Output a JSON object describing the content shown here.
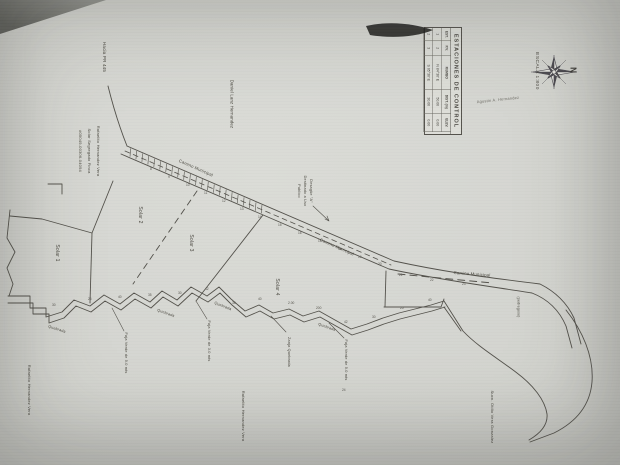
{
  "title_block": {
    "table": {
      "title": "ESTACIONES DE CONTROL",
      "headers": [
        "EST.",
        "P.V.",
        "RUMBO",
        "DIST. (m)",
        "ELEV."
      ],
      "rows": [
        [
          "1",
          "2",
          "N 84°30' E",
          "50.00",
          "0.00"
        ],
        [
          "2",
          "3",
          "S 05°30' E",
          "30.00",
          "0.00"
        ]
      ]
    },
    "escala": "ESCALA 1:800",
    "north": "N"
  },
  "labels": {
    "hacia": "Hacia PR 445",
    "neighbor_top": "Daniel Lanz Hernandez",
    "owner_line1": "Rafaelito Hernandez Vera",
    "owner_line2": "Solar Segregado Finca",
    "owner_line3": "#05049-00306-04094",
    "solar1": "Solar 1",
    "solar2": "Solar 2",
    "solar3": "Solar 3",
    "solar4": "Solar 4",
    "camino": "Camino Municipal",
    "desague_line1": "Desagüe \"A\"",
    "desague_line2": "Destinado a Uso",
    "desague_line3": "Publico",
    "agustin": "Agustin A. Hernandez",
    "quebrada": "Quebrada",
    "faja5": "Faja Verde de 5.0 mts",
    "faja3": "Faja Verde de 3.0 mts",
    "zanja": "Zanja Quebrada",
    "pedregoso": "(pedregoso)",
    "rafaelito": "Rafaelito Hernandez Vera",
    "otilio": "Sucn. Otilio Vera Gonzalez"
  },
  "ticks": {
    "road": [
      [
        150,
        170,
        "8"
      ],
      [
        168,
        178,
        "9"
      ],
      [
        186,
        186,
        "10"
      ],
      [
        204,
        194,
        "11"
      ],
      [
        222,
        202,
        "12"
      ],
      [
        240,
        210,
        "13"
      ],
      [
        258,
        218,
        "14"
      ],
      [
        278,
        226,
        "15"
      ],
      [
        298,
        234,
        "16"
      ],
      [
        318,
        242,
        "17"
      ],
      [
        338,
        250,
        "18"
      ],
      [
        358,
        258,
        "19"
      ],
      [
        378,
        265,
        "20"
      ],
      [
        399,
        276,
        "21"
      ],
      [
        430,
        281,
        "22"
      ],
      [
        462,
        285,
        "23"
      ]
    ],
    "creek": [
      [
        52,
        306,
        "30"
      ],
      [
        88,
        300,
        "25"
      ],
      [
        118,
        298,
        "40"
      ],
      [
        148,
        296,
        "35"
      ],
      [
        178,
        294,
        "30"
      ],
      [
        205,
        290,
        "42"
      ],
      [
        232,
        304,
        "38"
      ],
      [
        258,
        300,
        "40"
      ],
      [
        288,
        304,
        "2.00"
      ],
      [
        316,
        309,
        "200"
      ],
      [
        344,
        323,
        "42"
      ],
      [
        372,
        318,
        "30"
      ],
      [
        400,
        309,
        "25"
      ],
      [
        428,
        301,
        "40"
      ],
      [
        342,
        391,
        "24"
      ]
    ]
  }
}
